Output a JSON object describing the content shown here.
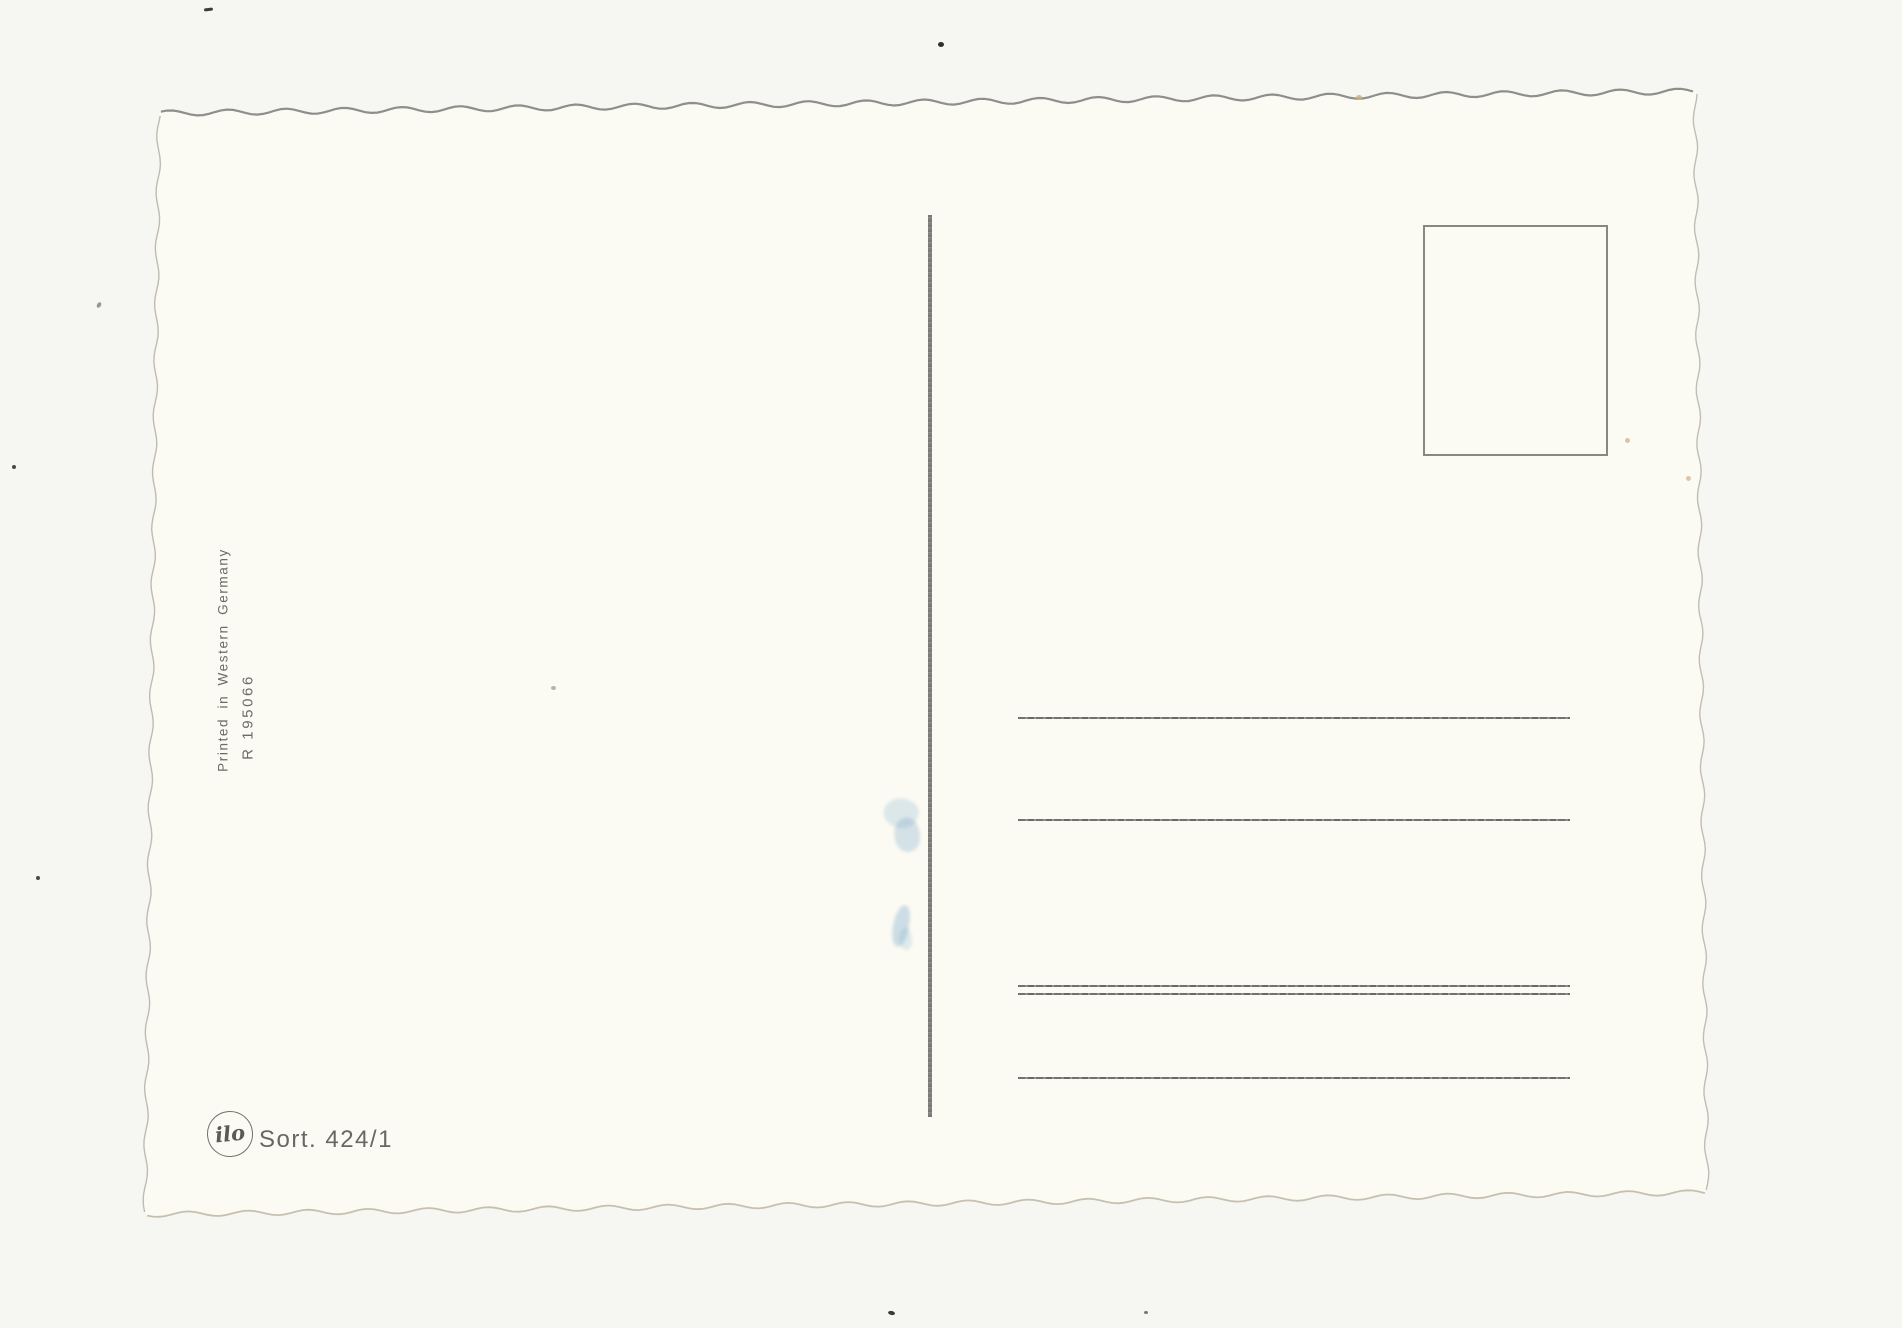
{
  "document_type": "postcard-back-scan",
  "card": {
    "side_notes": {
      "printed_in": "Printed in Western Germany",
      "reference": "R 195066"
    },
    "publisher": {
      "monogram": "ilo",
      "sort_number": "Sort. 424/1"
    },
    "address_area": {
      "line_count": 5,
      "has_double_rule": true
    },
    "stamp_box_present": true
  },
  "colors": {
    "page_background": "#f6f6f3",
    "card_surface": "#fcfbf3",
    "top_edge_shadow": "#8e8e8c",
    "rule_line": "#5f5f5c",
    "divider_line": "#6d6d6d",
    "printed_text": "#6b6b68",
    "ink_smudge_blue": "#6a9ec6"
  }
}
